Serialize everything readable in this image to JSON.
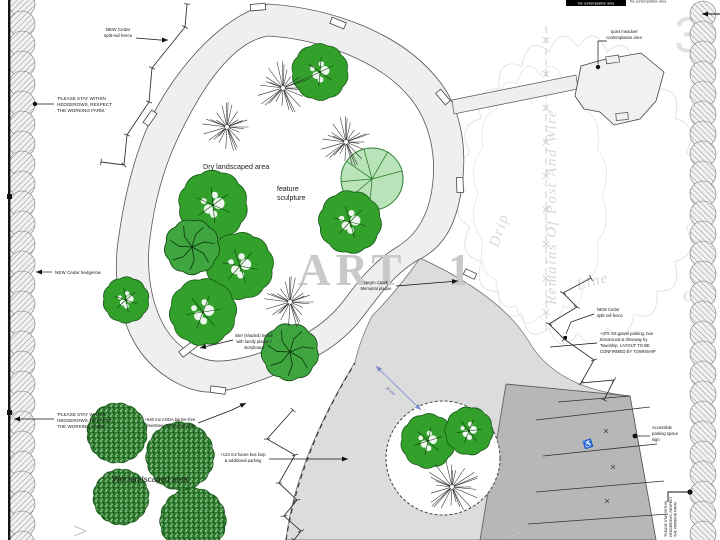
{
  "annotations": {
    "cedar_fence": {
      "lines": [
        "NEW Cedar",
        "split-rail fence"
      ]
    },
    "stay_within": {
      "lines": [
        "'PLEASE STAY WITHIN",
        "HEDGEROWS, RESPECT",
        "THE WORKING FARM.'"
      ]
    },
    "cedar_hedgerow": {
      "text": "NEW Cedar hedgerow"
    },
    "dry_area": {
      "text": "Dry landscaped area"
    },
    "feature_sculpture": {
      "lines": [
        "feature",
        "sculpture"
      ]
    },
    "memorial_plaque": {
      "lines": [
        "Negro Creek",
        "Memorial plaque"
      ]
    },
    "shaded_bench": {
      "lines": [
        "inter (shaded) bench",
        "with family plaque /",
        "storyboard"
      ]
    },
    "quiet_meadow": {
      "lines": [
        "'quiet meadow'",
        "contemplation area"
      ]
    },
    "top_partial": {
      "text": "the contemplation area"
    },
    "gravel_parking": {
      "lines": [
        "+479 m2 gravel parking, bus",
        "turnaround & driveway by",
        "Township. LAYOUT TO BE",
        "CONFIRMED BY TOWNSHIP"
      ]
    },
    "aoda_path": {
      "lines": [
        "+640 m2 AODA barrier-free",
        "limestone screenings path"
      ]
    },
    "bus_loop": {
      "lines": [
        "+134 m2 future bus loop",
        "& additional parking"
      ]
    },
    "accessible_sign": {
      "lines": [
        "Accessible",
        "parking space",
        "sign"
      ]
    },
    "wet_area": {
      "text": "Wet landscaped area"
    },
    "dimension": {
      "text": "Ø 10m"
    }
  },
  "ghost_text": {
    "remains": "Remains Of Post And Wire",
    "drip": "Drip",
    "line": "Line",
    "of": "Of",
    "sheet_number": "3",
    "watermark": "ART 1"
  },
  "symbols": {
    "accessible": "♿"
  },
  "colors": {
    "canopy_green": "#33a02c",
    "feature_green": "#b9e4b9",
    "wet_green": "#2e7d2e",
    "plaza_gray": "#dcdcdc",
    "parking_gray": "#b7b7b7",
    "ghost_gray": "#d8d8d8"
  }
}
